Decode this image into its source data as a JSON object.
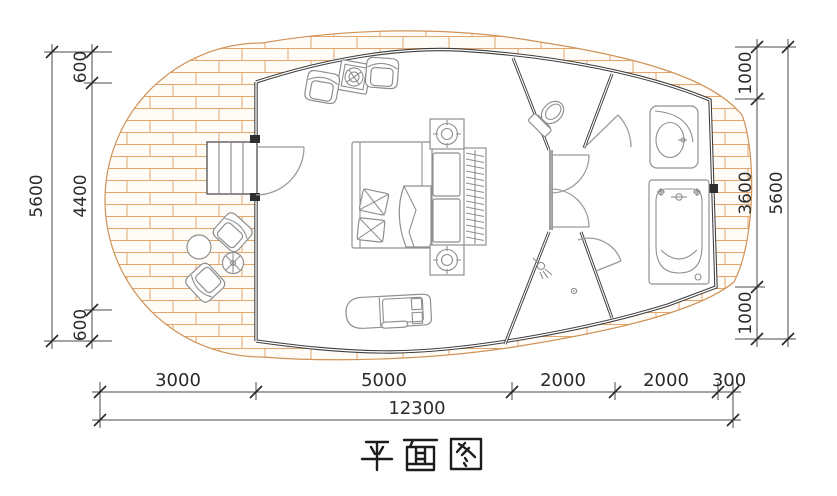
{
  "title": "平面图",
  "dims": {
    "left": {
      "total": "5600",
      "segments": [
        "600",
        "4400",
        "600"
      ]
    },
    "right": {
      "total": "5600",
      "segments": [
        "1000",
        "3600",
        "1000"
      ]
    },
    "bottom": {
      "total": "12300",
      "segments": [
        "3000",
        "5000",
        "2000",
        "2000",
        "300"
      ]
    }
  },
  "rooms": [
    "bedroom",
    "toilet-room",
    "hallway",
    "shower-room",
    "bath-area",
    "outdoor-deck"
  ],
  "furniture": [
    "double-bed",
    "headboard-cabinets",
    "wardrobe",
    "armchairs",
    "tea-table",
    "lounge-sofa",
    "entry-stairs",
    "outdoor-round-table",
    "outdoor-side-table",
    "outdoor-armchairs",
    "toilet",
    "wash-basin",
    "bathtub",
    "shower-head",
    "floor-drain"
  ],
  "colors": {
    "brick_hatch": "#e3a66f",
    "wall_line": "#3c3c3c",
    "furniture_line": "#8f8f8f",
    "dimension_text": "#2b2b2b",
    "paper": "#ffffff"
  }
}
